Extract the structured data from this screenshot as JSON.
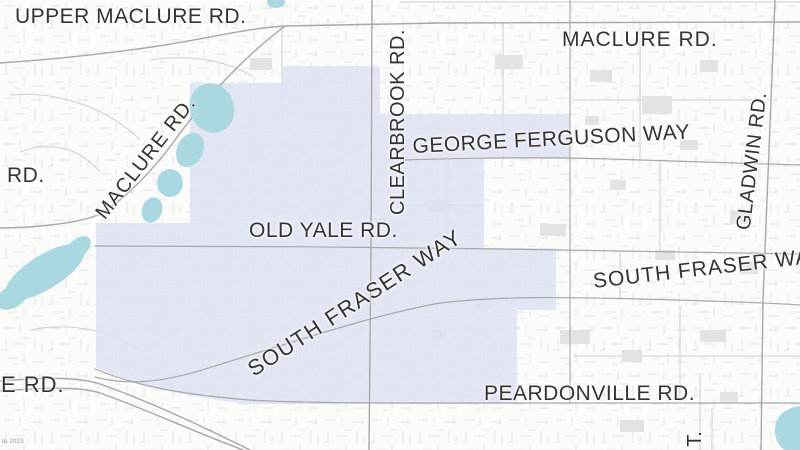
{
  "map": {
    "labels": {
      "upper_maclure_rd": "UPPER MACLURE RD.",
      "maclure_rd_top": "MACLURE RD.",
      "rd_left_edge": "RD.",
      "maclure_rd_diagonal": "MACLURE RD.",
      "clearbrook_rd": "CLEARBROOK RD.",
      "george_ferguson_way": "GEORGE FERGUSON WAY",
      "gladwin_rd": "GLADWIN RD.",
      "old_yale_rd": "OLD YALE RD.",
      "south_fraser_way_diagonal": "SOUTH FRASER WAY",
      "south_fraser_way_right": "SOUTH FRASER WAY",
      "peardonville_rd": "PEARDONVILLE RD.",
      "e_rd_left_edge": "E RD.",
      "street_partial_t": "T.",
      "attribution": "to 2023"
    },
    "colors": {
      "background": "#fbfbfa",
      "highlight_region": "#dde2f1",
      "water": "#abd7e1",
      "road_major": "#a8a8a5",
      "road_minor": "#cfcfcc",
      "building": "#e3e3e0",
      "label_text": "#333333"
    }
  }
}
